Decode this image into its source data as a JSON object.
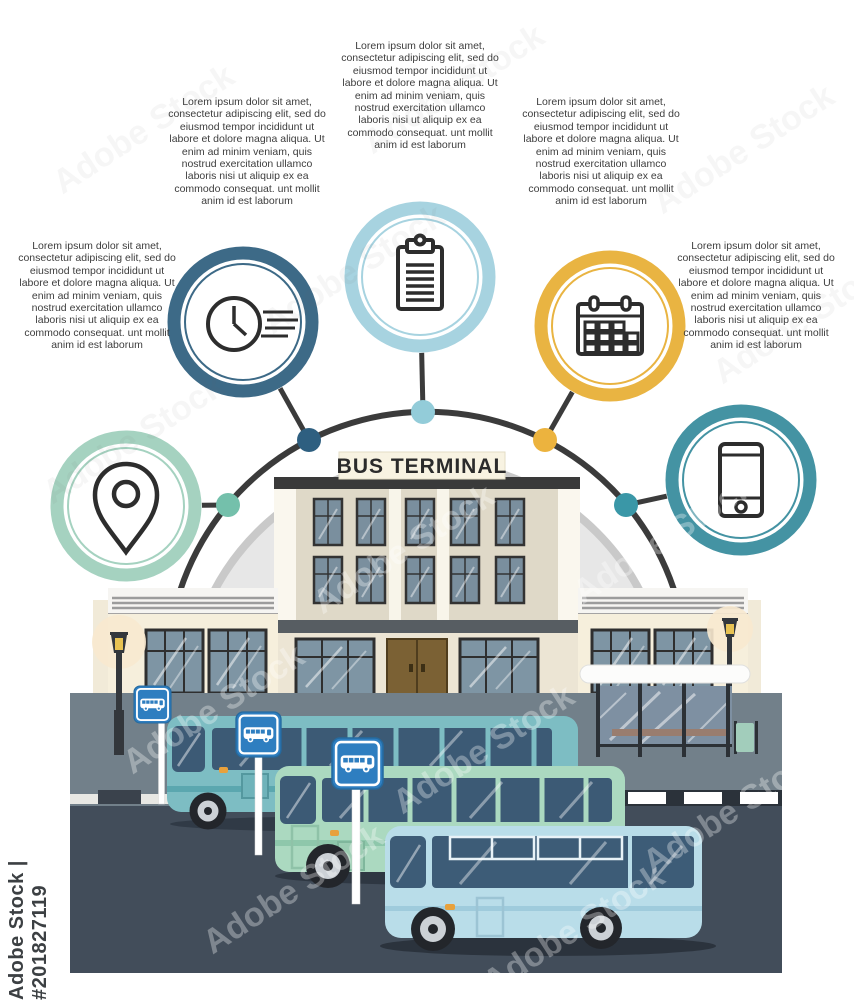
{
  "sign": {
    "label": "BUS TERMINAL"
  },
  "watermark": {
    "vertical": "Adobe Stock | #201827119",
    "tile": "Adobe Stock"
  },
  "text_blocks": [
    {
      "position": "top-center",
      "linked_icon": "clipboard-icon",
      "text": "Lorem ipsum dolor sit amet, consectetur adipiscing elit, sed do eiusmod tempor incididunt ut labore et dolore magna aliqua. Ut enim ad minim veniam, quis nostrud exercitation ullamco laboris nisi ut aliquip ex ea commodo consequat. unt mollit anim id est laborum"
    },
    {
      "position": "upper-left",
      "linked_icon": "clock-icon",
      "text": "Lorem ipsum dolor sit amet, consectetur adipiscing elit, sed do eiusmod tempor incididunt ut labore et dolore magna aliqua. Ut enim ad minim veniam, quis nostrud exercitation ullamco laboris nisi ut aliquip ex ea commodo consequat. unt mollit anim id est laborum"
    },
    {
      "position": "upper-right",
      "linked_icon": "calendar-icon",
      "text": "Lorem ipsum dolor sit amet, consectetur adipiscing elit, sed do eiusmod tempor incididunt ut labore et dolore magna aliqua. Ut enim ad minim veniam, quis nostrud exercitation ullamco laboris nisi ut aliquip ex ea commodo consequat. unt mollit anim id est laborum"
    },
    {
      "position": "left",
      "linked_icon": "location-pin-icon",
      "text": "Lorem ipsum dolor sit amet, consectetur adipiscing elit, sed do eiusmod tempor incididunt ut labore et dolore magna aliqua. Ut enim ad minim veniam, quis nostrud exercitation ullamco laboris nisi ut aliquip ex ea commodo consequat. unt mollit anim id est laborum"
    },
    {
      "position": "right",
      "linked_icon": "smartphone-icon",
      "text": "Lorem ipsum dolor sit amet, consectetur adipiscing elit, sed do eiusmod tempor incididunt ut labore et dolore magna aliqua. Ut enim ad minim veniam, quis nostrud exercitation ullamco laboris nisi ut aliquip ex ea commodo consequat. unt mollit anim id est laborum"
    }
  ],
  "nodes": [
    {
      "id": "location-pin",
      "ring": "#a5d2c0",
      "dot": "#74c0ab"
    },
    {
      "id": "clock",
      "ring": "#3d6a87",
      "dot": "#2e5f80"
    },
    {
      "id": "clipboard",
      "ring": "#a7d3e0",
      "dot": "#93ccd9"
    },
    {
      "id": "calendar",
      "ring": "#e9b442",
      "dot": "#ecb33e"
    },
    {
      "id": "smartphone",
      "ring": "#4493a3",
      "dot": "#3a97a7"
    }
  ],
  "colors": {
    "arc": "#3b3b3b",
    "dome": "#e7e7e7",
    "building_facade": "#dfd9c8",
    "wing_facade": "#f6efdc",
    "entablature": "#3a3a3a",
    "door": "#7b6134",
    "glass": "#7a8f9e",
    "wall": "#72808a",
    "asphalt": "#424d5a",
    "bus_teal": "#7dbdc3",
    "bus_mint": "#abd9c0",
    "bus_blue": "#b9dde9",
    "bus_window": "#3c5a75",
    "stop_sign_blue": "#2e7ec0",
    "lamp_glow": "#f8e9cf"
  }
}
